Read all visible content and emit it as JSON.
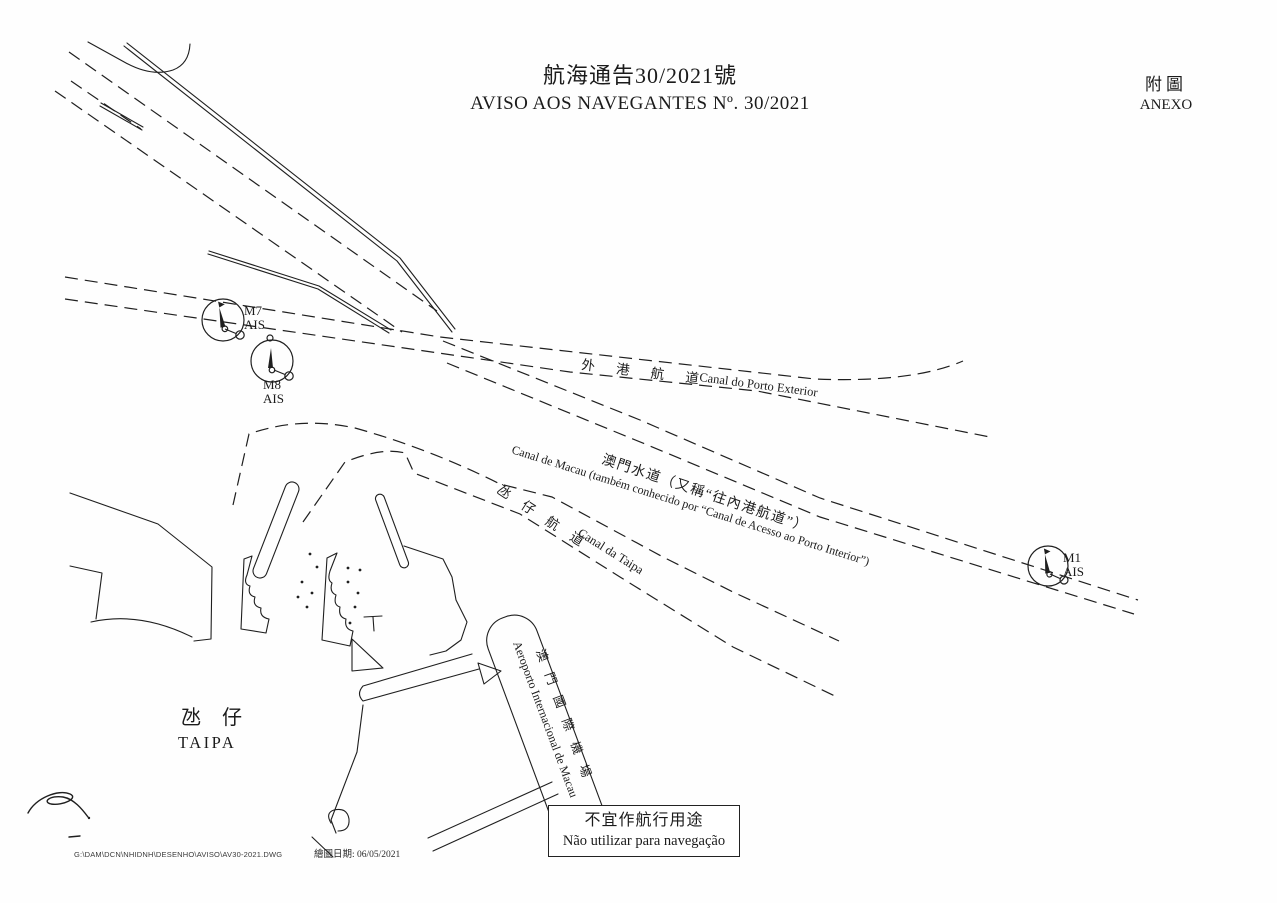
{
  "page": {
    "title_zh": "航海通告30/2021號",
    "title_pt": "AVISO AOS NAVEGANTES Nº. 30/2021",
    "annex_zh": "附圖",
    "annex_pt": "ANEXO"
  },
  "channels": {
    "porto_exterior": {
      "zh": "外 港 航 道",
      "pt": "Canal do Porto Exterior"
    },
    "macau": {
      "zh": "澳門水道（又稱“往內港航道”）",
      "pt": "Canal de Macau (também conhecido por “Canal de Acesso ao Porto Interior”)"
    },
    "taipa": {
      "zh": "氹 仔 航 道",
      "pt": "Canal da Taipa"
    }
  },
  "buoys": {
    "m7": {
      "name": "M7",
      "type": "AIS"
    },
    "m8": {
      "name": "M8",
      "type": "AIS"
    },
    "m1": {
      "name": "M1",
      "type": "AIS"
    }
  },
  "places": {
    "taipa": {
      "zh": "氹 仔",
      "pt": "TAIPA"
    },
    "airport": {
      "zh": "澳 門 國 際 機 場",
      "pt": "Aeroporto Internacional de Macau"
    }
  },
  "notice": {
    "zh": "不宜作航行用途",
    "pt": "Não utilizar para navegação"
  },
  "footer": {
    "file_path": "G:\\DAM\\DCN\\NHIDNH\\DESENHO\\AVISO\\AV30-2021.DWG",
    "date": "繪圖日期: 06/05/2021"
  }
}
